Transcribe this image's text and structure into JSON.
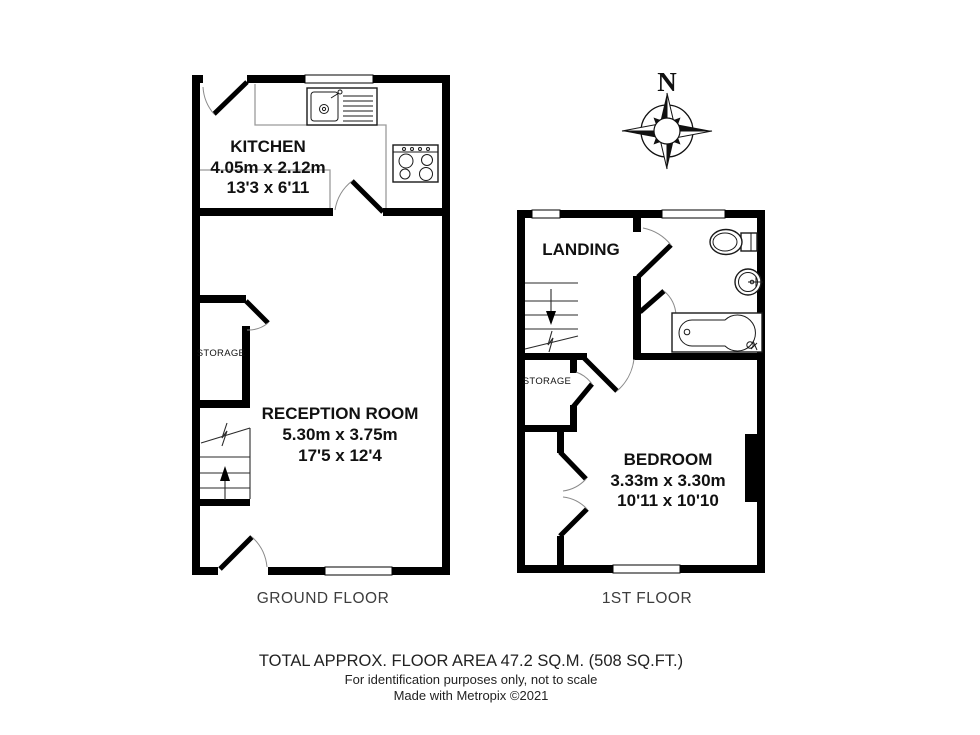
{
  "ground_floor": {
    "label": "GROUND FLOOR",
    "rooms": {
      "kitchen": {
        "name": "KITCHEN",
        "metric": "4.05m x 2.12m",
        "imperial": "13'3 x 6'11"
      },
      "reception": {
        "name": "RECEPTION ROOM",
        "metric": "5.30m x 3.75m",
        "imperial": "17'5 x 12'4"
      },
      "storage": {
        "name": "STORAGE"
      }
    }
  },
  "first_floor": {
    "label": "1ST FLOOR",
    "rooms": {
      "landing": {
        "name": "LANDING"
      },
      "storage": {
        "name": "STORAGE"
      },
      "bedroom": {
        "name": "BEDROOM",
        "metric": "3.33m x 3.30m",
        "imperial": "10'11 x 10'10"
      }
    }
  },
  "compass": {
    "north_label": "N"
  },
  "footer": {
    "total_area": "TOTAL APPROX. FLOOR AREA 47.2 SQ.M. (508 SQ.FT.)",
    "disclaimer": "For identification purposes only, not to scale",
    "credit": "Made with Metropix ©2021"
  },
  "colors": {
    "wall": "#000000",
    "counter_outline": "#9b9b9b",
    "door_arc": "#8a8a8a",
    "label_text": "#111111",
    "floor_label_text": "#3d3d3d"
  }
}
